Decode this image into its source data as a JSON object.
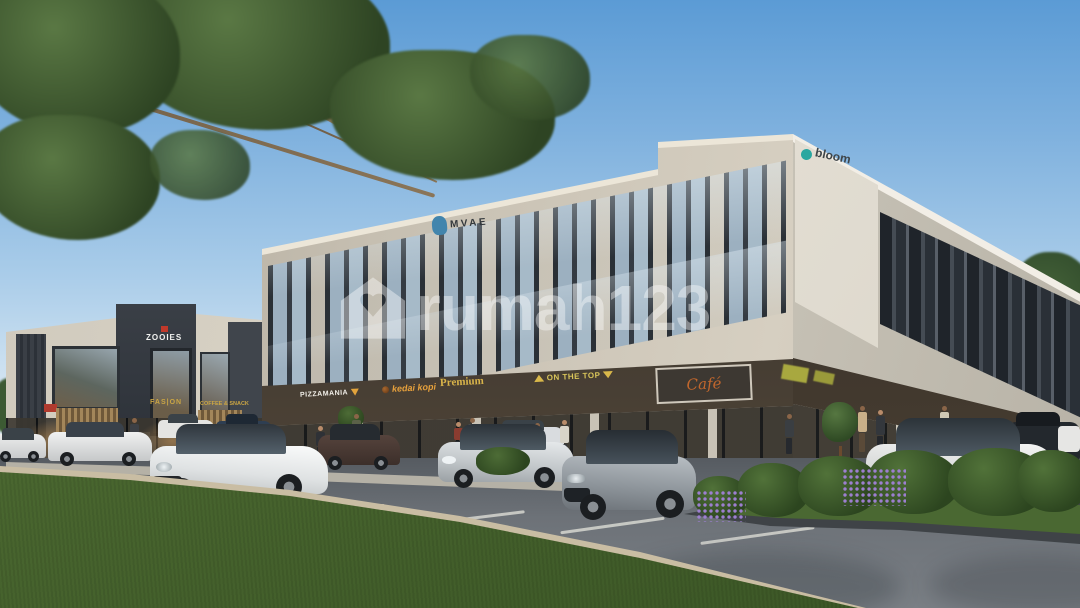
{
  "watermark": {
    "text": "rumah123",
    "icon": "house-icon",
    "color": "#ffffff"
  },
  "main_building": {
    "roof_logo": {
      "label": "MVAE",
      "icon": "elephant-icon",
      "icon_color": "#4285ad",
      "text_color": "#33383c"
    },
    "corner_logo": {
      "label": "bloom",
      "icon": "dot-icon",
      "icon_color": "#2aa7a0",
      "text_color": "#3f4549"
    },
    "storefront_signs": [
      {
        "label": "PIZZAMANIA",
        "color": "#f2efe9",
        "icon": "pizza-icon"
      },
      {
        "label": "kedai kopi",
        "color": "#e8a13c",
        "icon": "coffee-bean-icon"
      },
      {
        "label": "Premium",
        "color": "#d9b44a"
      },
      {
        "label": "ON THE TOP",
        "color": "#d9c55a",
        "icon": "triangle-icons"
      },
      {
        "label": "Café",
        "color": "#c2672d"
      }
    ]
  },
  "left_building": {
    "roof_sign": {
      "label": "ZOOIES",
      "color": "#f2f2f0",
      "icon": "red-mark-icon"
    },
    "shop_signs": [
      {
        "label": "FAS|ON",
        "color": "#caa544"
      },
      {
        "label": "COFFEE & SNACK",
        "color": "#caa544"
      }
    ]
  },
  "scene": {
    "type": "3D exterior rendering of modern two-storey shophouse complex with parking lot",
    "sky_color": "#7fb1de",
    "grass_color": "#49662f",
    "asphalt_color": "#6d7278",
    "facade_color": "#cfc8ba",
    "frame_color": "#2a2f35"
  }
}
